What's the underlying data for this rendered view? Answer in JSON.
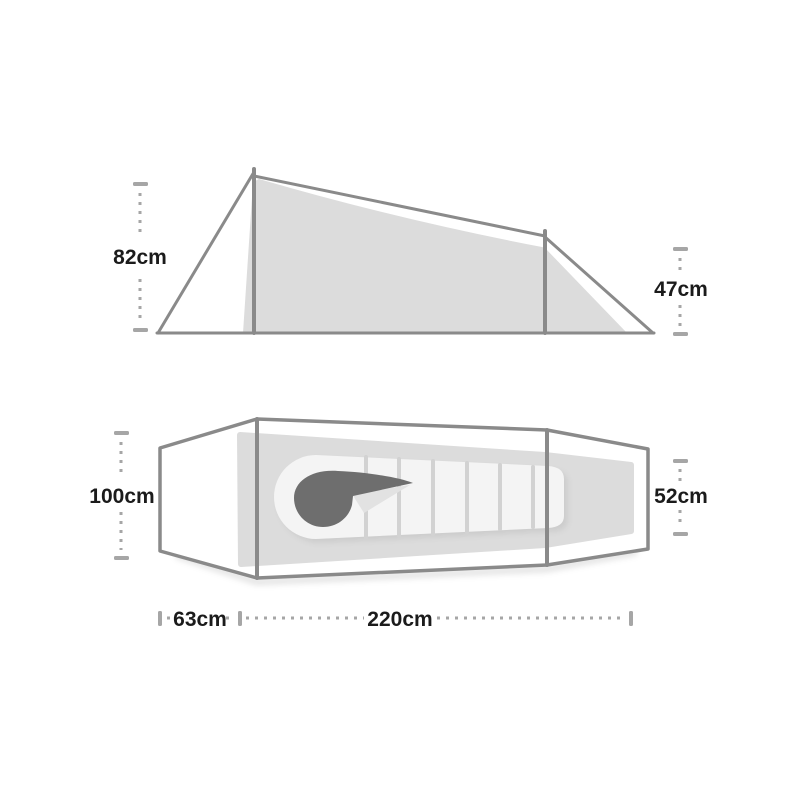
{
  "title": "Tent dimensions diagram",
  "side_view": {
    "name": "Side elevation",
    "front_height_label": "82cm",
    "rear_height_label": "47cm"
  },
  "top_view": {
    "name": "Floor plan with sleeping bag",
    "head_width_label": "100cm",
    "foot_width_label": "52cm",
    "vestibule_length_label": "63cm",
    "inner_length_label": "220cm"
  },
  "measurements_cm": {
    "front_height": 82,
    "rear_height": 47,
    "head_width": 100,
    "foot_width": 52,
    "vestibule_length": 63,
    "inner_length": 220
  },
  "colors": {
    "background": "#ffffff",
    "outline": "#8a8a8a",
    "fabric_fill": "#dcdcdc",
    "sleeping_bag": "#f4f4f4",
    "baffle_line": "#d2d2d2",
    "hood": "#6e6e6e",
    "collar_shadow": "#e2e2e2",
    "dimension_marks": "#a6a6a6",
    "label_text": "#1b1b1b"
  }
}
